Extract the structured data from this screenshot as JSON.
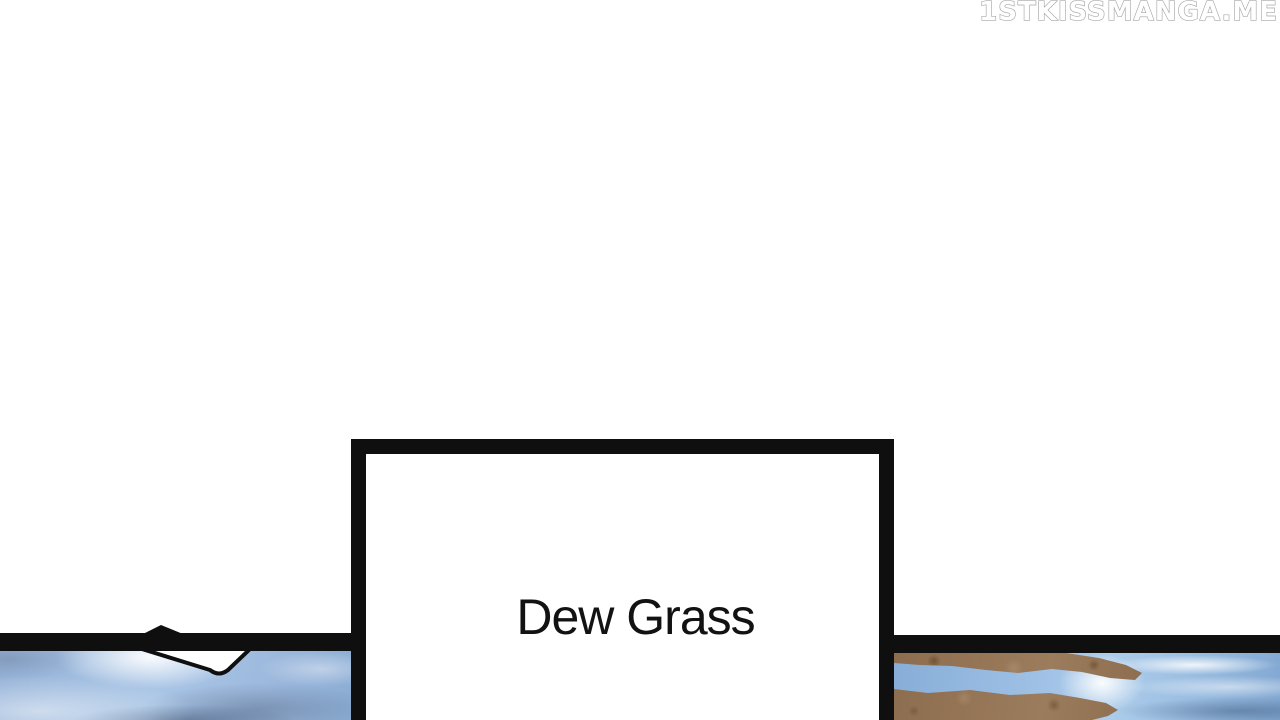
{
  "watermark": {
    "text": "1STKISSMANGA.ME"
  },
  "caption_box": {
    "text": "Dew Grass"
  },
  "colors": {
    "ink": "#0f0f0f",
    "paper": "#ffffff",
    "watermark_fill": "#ffffff",
    "watermark_outline": "#a6a6a6",
    "caption_text": "#121212",
    "water_base": "#a3c0e2",
    "rock_base": "#937254",
    "stream_blue": "#8ab2dc"
  }
}
